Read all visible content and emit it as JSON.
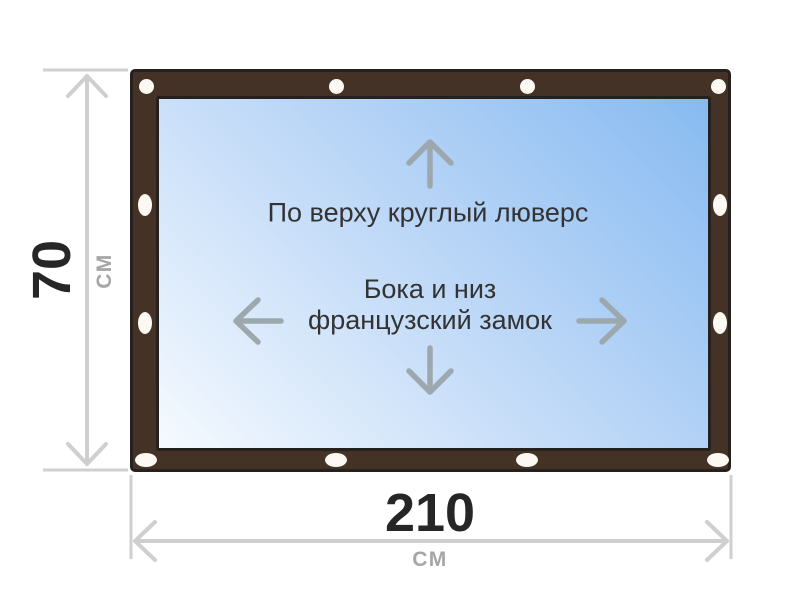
{
  "colors": {
    "background": "#ffffff",
    "frame": "#453227",
    "frame_border": "#26211d",
    "panel_light": "#f5faff",
    "panel_mid": "#bcd7f7",
    "panel_deep": "#87baf1",
    "grommet": "#fbf9f2",
    "dim_line": "#cfcfcf",
    "dim_value": "#262626",
    "dim_unit": "#a6a6a6",
    "note_text": "#333333",
    "note_arrow": "#9da7ae"
  },
  "diagram": {
    "product": {
      "grommets": [
        {
          "cx": 13,
          "cy": 14,
          "w": 15,
          "h": 15
        },
        {
          "cx": 203,
          "cy": 14,
          "w": 15,
          "h": 15
        },
        {
          "cx": 394,
          "cy": 14,
          "w": 15,
          "h": 15
        },
        {
          "cx": 585,
          "cy": 14,
          "w": 15,
          "h": 15
        },
        {
          "cx": 12,
          "cy": 133,
          "w": 14,
          "h": 22
        },
        {
          "cx": 12,
          "cy": 251,
          "w": 14,
          "h": 22
        },
        {
          "cx": 587,
          "cy": 133,
          "w": 14,
          "h": 22
        },
        {
          "cx": 587,
          "cy": 251,
          "w": 14,
          "h": 22
        },
        {
          "cx": 13,
          "cy": 388,
          "w": 22,
          "h": 14
        },
        {
          "cx": 203,
          "cy": 388,
          "w": 22,
          "h": 14
        },
        {
          "cx": 394,
          "cy": 388,
          "w": 22,
          "h": 14
        },
        {
          "cx": 585,
          "cy": 388,
          "w": 22,
          "h": 14
        }
      ]
    },
    "annotations": {
      "top_note": "По верху круглый люверс",
      "middle_note_line1": "Бока и низ",
      "middle_note_line2": "французский замок"
    },
    "dimensions": {
      "height": {
        "value": "70",
        "unit": "СМ"
      },
      "width": {
        "value": "210",
        "unit": "СМ"
      }
    }
  }
}
